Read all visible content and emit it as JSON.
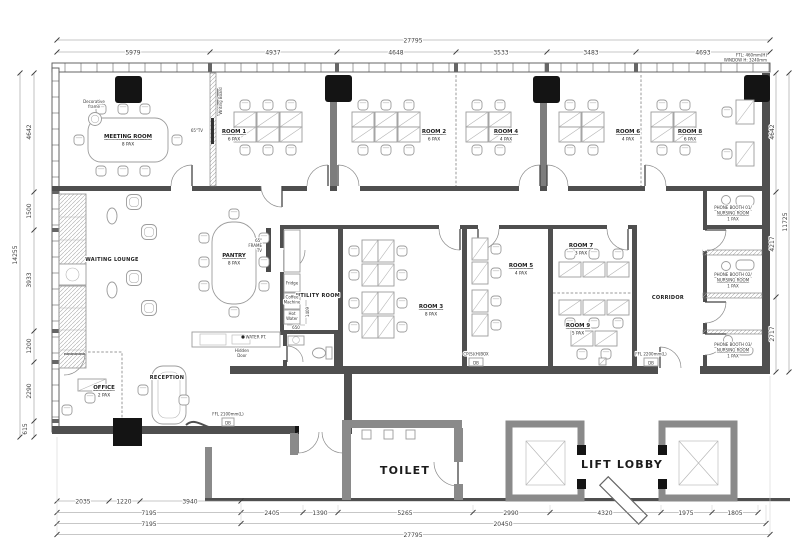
{
  "rooms": {
    "meeting": {
      "name": "MEETING ROOM",
      "pax": "8 PAX"
    },
    "room1": {
      "name": "ROOM 1",
      "pax": "6 PAX"
    },
    "room2": {
      "name": "ROOM 2",
      "pax": "6 PAX"
    },
    "room3": {
      "name": "ROOM 3",
      "pax": "8 PAX"
    },
    "room4": {
      "name": "ROOM 4",
      "pax": "4 PAX"
    },
    "room5": {
      "name": "ROOM 5",
      "pax": "4 PAX"
    },
    "room6": {
      "name": "ROOM 6",
      "pax": "4 PAX"
    },
    "room7": {
      "name": "ROOM 7",
      "pax": "3 PAX"
    },
    "room8": {
      "name": "ROOM 8",
      "pax": "6 PAX"
    },
    "room9": {
      "name": "ROOM 9",
      "pax": "5 PAX"
    },
    "pantry": {
      "name": "PANTRY",
      "pax": "8 PAX"
    },
    "office": {
      "name": "OFFICE",
      "pax": "2 PAX"
    },
    "booth1": {
      "line1": "PHONE BOOTH 01/",
      "line2": "NURSING ROOM",
      "pax": "1 PAX"
    },
    "booth2": {
      "line1": "PHONE BOOTH 02/",
      "line2": "NURSING ROOM",
      "pax": "1 PAX"
    },
    "booth3": {
      "line1": "PHONE BOOTH 03/",
      "line2": "NURSING ROOM",
      "pax": "1 PAX"
    }
  },
  "areas": {
    "waiting_lounge": "WAITING LOUNGE",
    "reception": "RECEPTION",
    "utility_room": "UTILITY ROOM",
    "corridor": "CORRIDOR",
    "toilet": "TOILET",
    "lift_lobby": "LIFT LOBBY"
  },
  "annotations": {
    "decorative_frame_1": "Decorative",
    "decorative_frame_2": "frame",
    "tv_65": "65\"TV",
    "writing_board": "Writing Board",
    "frame_tv_1": "65\"",
    "frame_tv_2": "FRAME",
    "frame_tv_3": "TV",
    "fridge": "Fridge",
    "coffee_1": "Coffee",
    "coffee_2": "Machine",
    "hot_water_1": "Hot",
    "hot_water_2": "Water",
    "hidden_door_1": "Hidden",
    "hidden_door_2": "Door",
    "water_pt": "WATER PT.",
    "db": "DB",
    "db_entry": "FFL 2100mm(L)",
    "db_room3": "CP(S)(H)BOX",
    "db_room9": "FFL 2200mm(L)",
    "window_note_1": "FTL: 460mm(H)",
    "window_note_2": "WINDOW H: 3240mm"
  },
  "dimensions": {
    "top": {
      "overall": "27795",
      "seg1": "5979",
      "seg2": "4937",
      "seg3": "4648",
      "seg4": "3533",
      "seg5": "3483",
      "seg6": "4693"
    },
    "left": {
      "overall": "14255",
      "seg1": "4642",
      "seg2": "1500",
      "seg3": "3933",
      "seg4": "1200",
      "seg5": "2290",
      "seg6": "615"
    },
    "right": {
      "overall": "11725",
      "seg1": "4642",
      "seg2": "4217",
      "seg3": "2717"
    },
    "bottom": {
      "r1a": "2035",
      "r1b": "1220",
      "r1c": "3940",
      "r2a": "7195",
      "r2b": "2405",
      "r2c": "1390",
      "r2d": "5265",
      "r2e": "2990",
      "r2f": "4320",
      "r2g": "1975",
      "r2h": "1805",
      "r3a": "7195",
      "r3b": "20450",
      "r4a": "27795"
    },
    "utility": {
      "a": "1409",
      "b": "650"
    }
  }
}
